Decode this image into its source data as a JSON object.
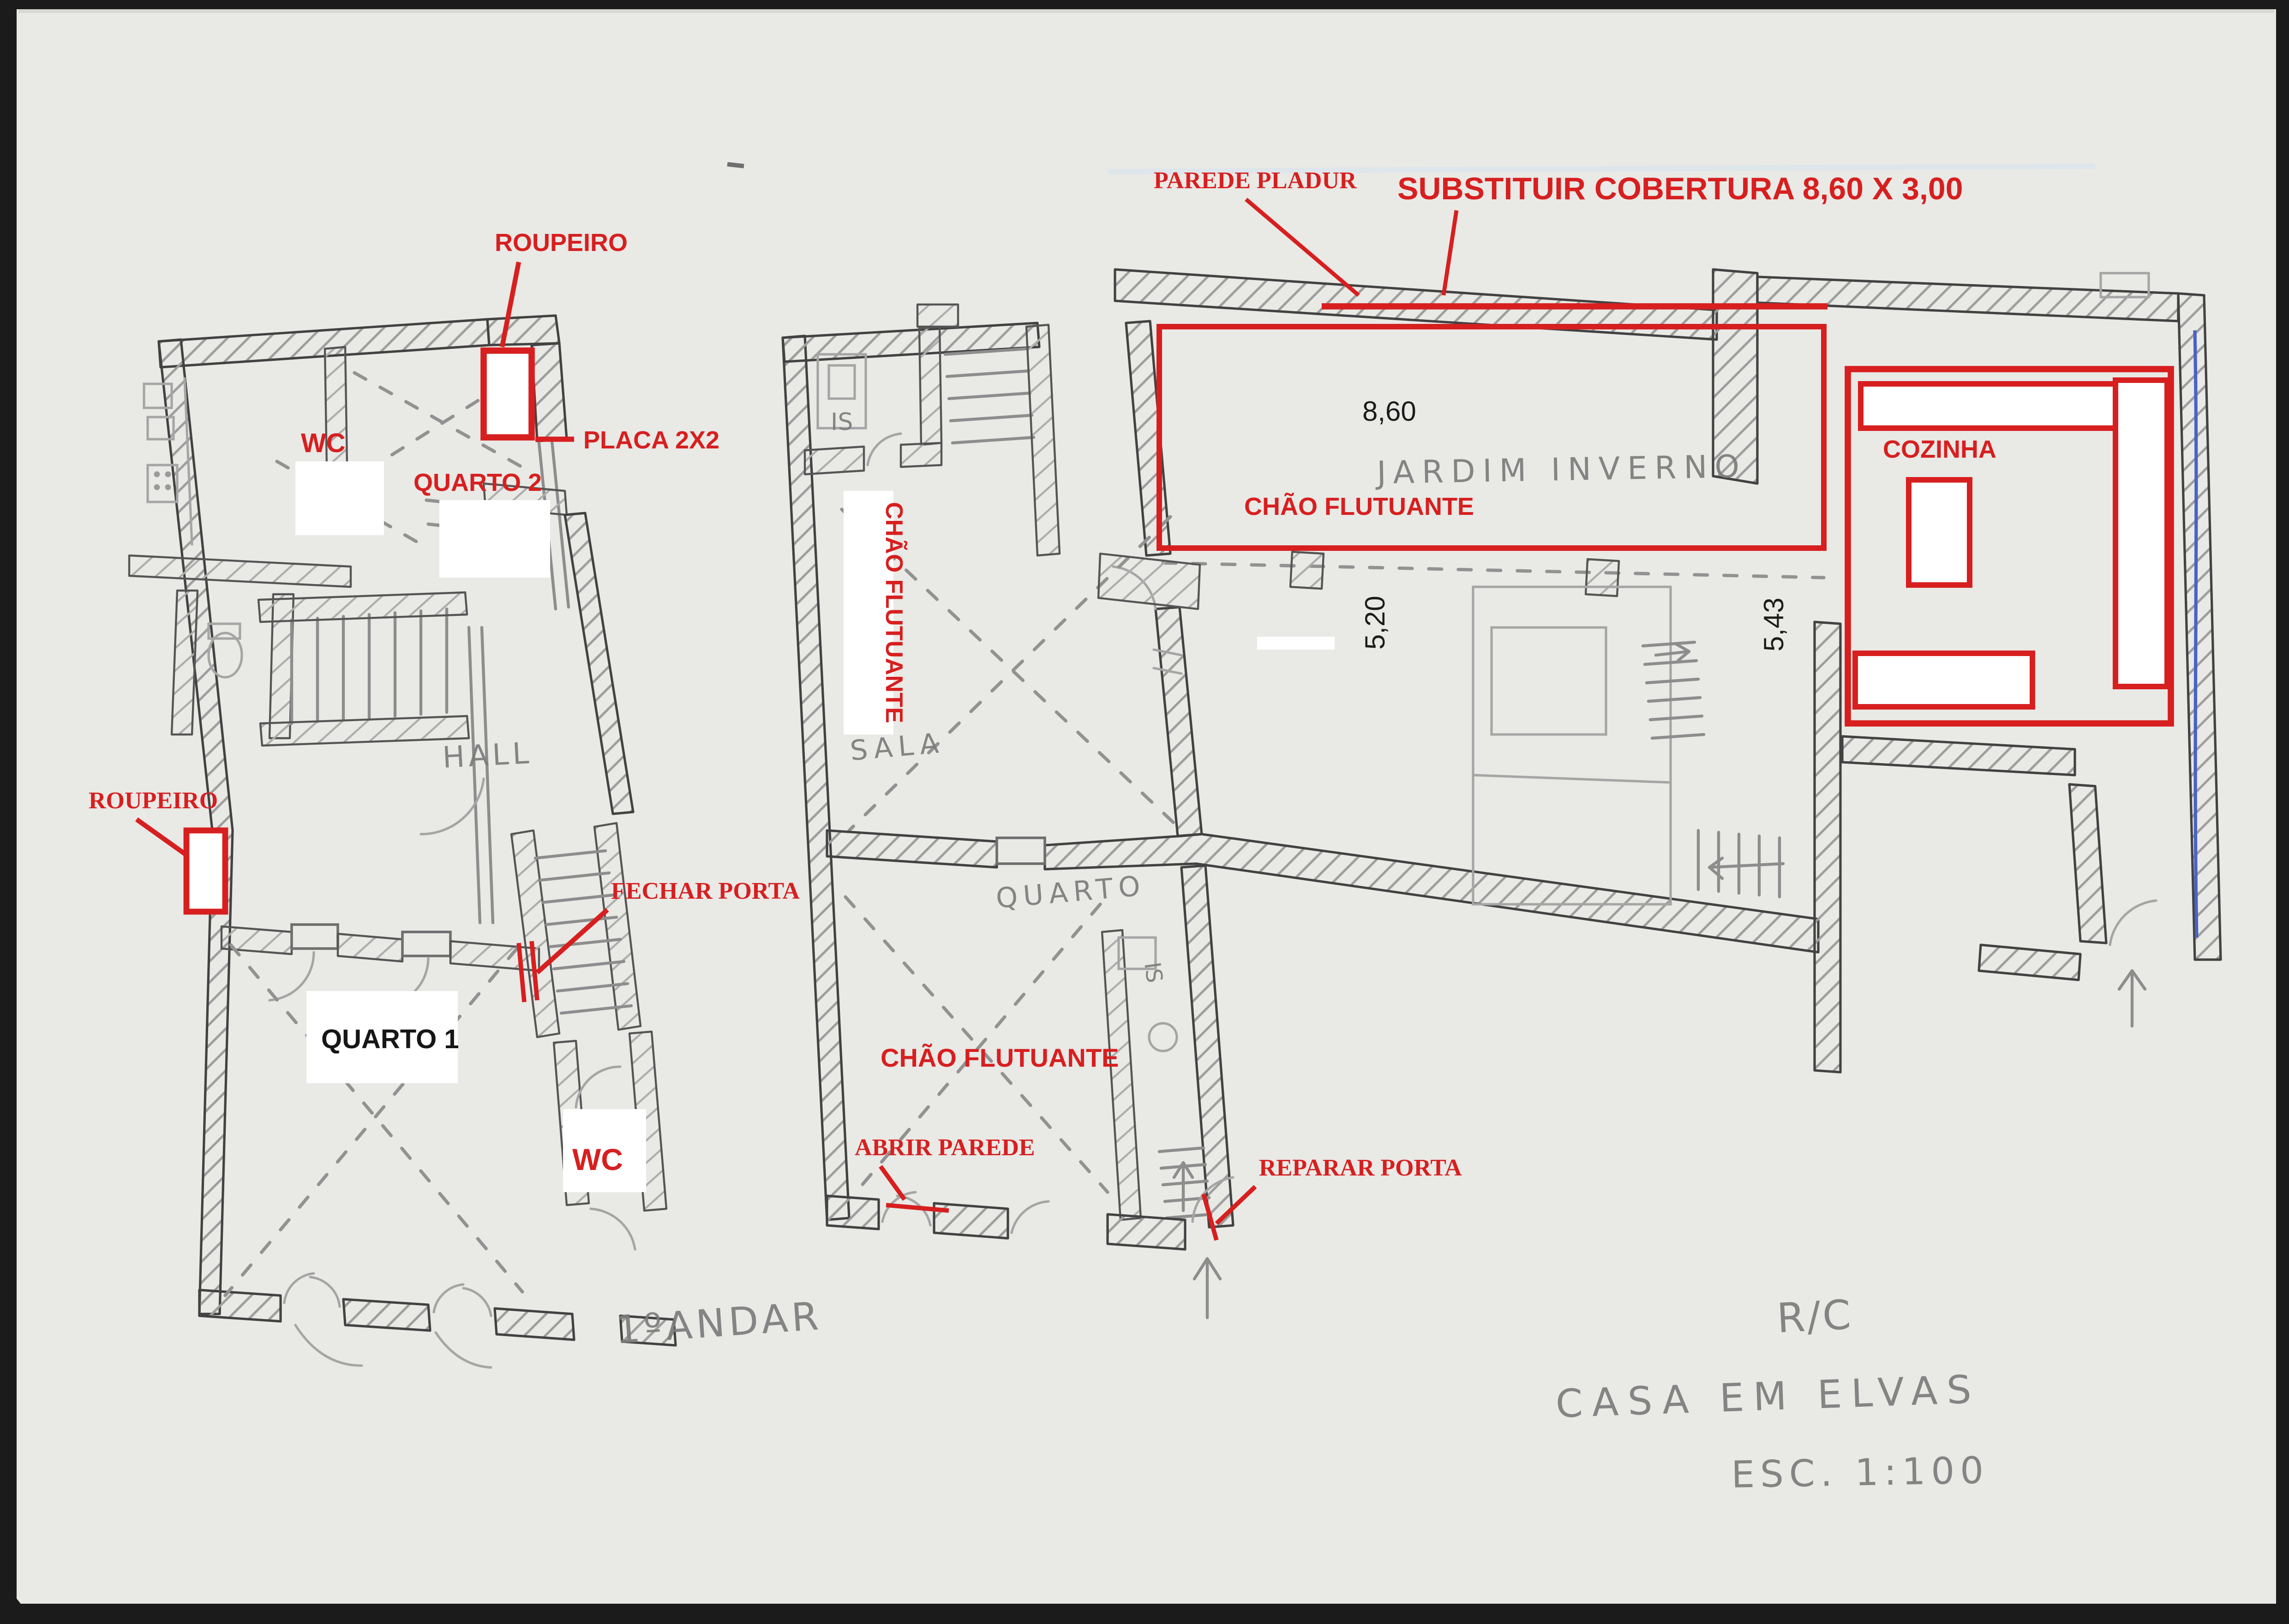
{
  "document": {
    "kind_note": "hand-drawn house floor plan scan with red renovation annotations",
    "colors": {
      "annotation_red": "#d71f1f",
      "pencil_gray": "#7c7c7c",
      "wall_ink": "#424242",
      "paper": "#e9e9e6",
      "pen_blue": "#4a62c4",
      "black_text": "#161616"
    }
  },
  "first_floor": {
    "caption": "1ºANDAR",
    "red_labels": {
      "roupeiro_top": "ROUPEIRO",
      "placa": "PLACA 2X2",
      "wc_top": "WC",
      "quarto2": "QUARTO 2",
      "roupeiro_left": "ROUPEIRO",
      "fechar_porta": "FECHAR PORTA",
      "wc_bottom": "WC"
    },
    "black_labels": {
      "quarto1": "QUARTO 1"
    },
    "pencil_labels": {
      "hall": "HALL"
    }
  },
  "ground_floor": {
    "caption": "R/C",
    "red_labels": {
      "parede_pladur": "PAREDE PLADUR",
      "substituir": "SUBSTITUIR COBERTURA 8,60 X 3,00",
      "chao_vertical": "CHÃO FLUTUANTE",
      "chao_mid": "CHÃO FLUTUANTE",
      "chao_jardim": "CHÃO FLUTUANTE",
      "abrir_parede": "ABRIR PAREDE",
      "reparar_porta": "REPARAR PORTA",
      "cozinha": "COZINHA"
    },
    "dimensions": {
      "d860": "8,60",
      "d520": "5,20",
      "d543": "5,43"
    },
    "pencil_labels": {
      "is_top": "IS",
      "sala": "SALA",
      "quarto": "QUARTO",
      "is_small": "IS",
      "jardim": "JARDIM INVERNO"
    }
  },
  "title_block": {
    "floor": "R/C",
    "project": "CASA EM ELVAS",
    "scale": "ESC. 1:100"
  }
}
